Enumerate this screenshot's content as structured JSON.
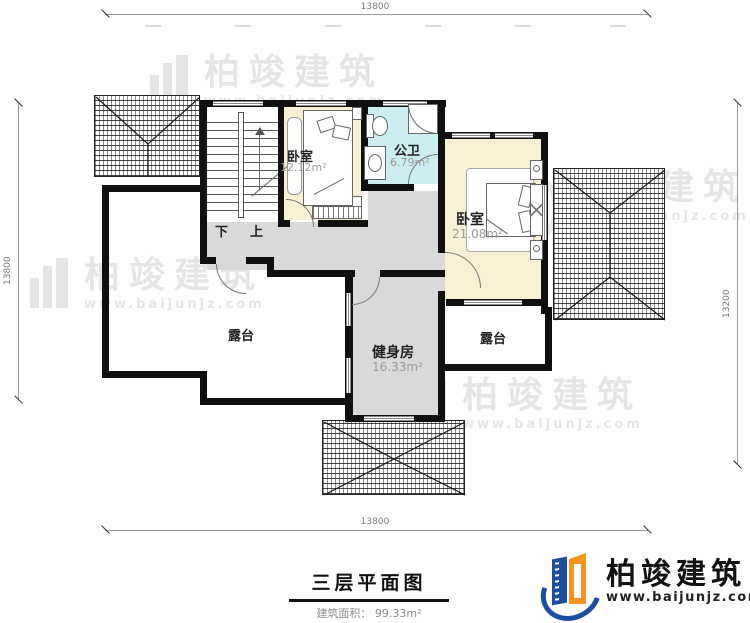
{
  "title": {
    "text": "三层平面图",
    "area": "建筑面积： 99.33m²"
  },
  "dims": {
    "top": "13800",
    "bottom": "13800",
    "left": "13800",
    "right": "13200"
  },
  "rooms": {
    "bedroom_small": {
      "name": "卧室",
      "area": "12.12m²"
    },
    "bathroom": {
      "name": "公卫",
      "area": "6.79m²"
    },
    "bedroom_master": {
      "name": "卧室",
      "area": "21.08m²"
    },
    "gym": {
      "name": "健身房",
      "area": "16.33m²"
    },
    "terrace_left": {
      "name": "露台"
    },
    "terrace_right": {
      "name": "露台"
    }
  },
  "stairs": {
    "down": "下",
    "up": "上"
  },
  "watermark": {
    "brand": "柏竣建筑",
    "url": "www.baijunjz.com"
  },
  "logo": {
    "brand": "柏竣建筑",
    "url": "www.baijunjz.com"
  },
  "colors": {
    "wall": "#101010",
    "floor_room": "#f8f0d5",
    "floor_bath": "#cdeef0",
    "floor_hall": "#d9d9d9",
    "logo_blue": "#1b4f9f",
    "logo_orange": "#f7941d"
  }
}
